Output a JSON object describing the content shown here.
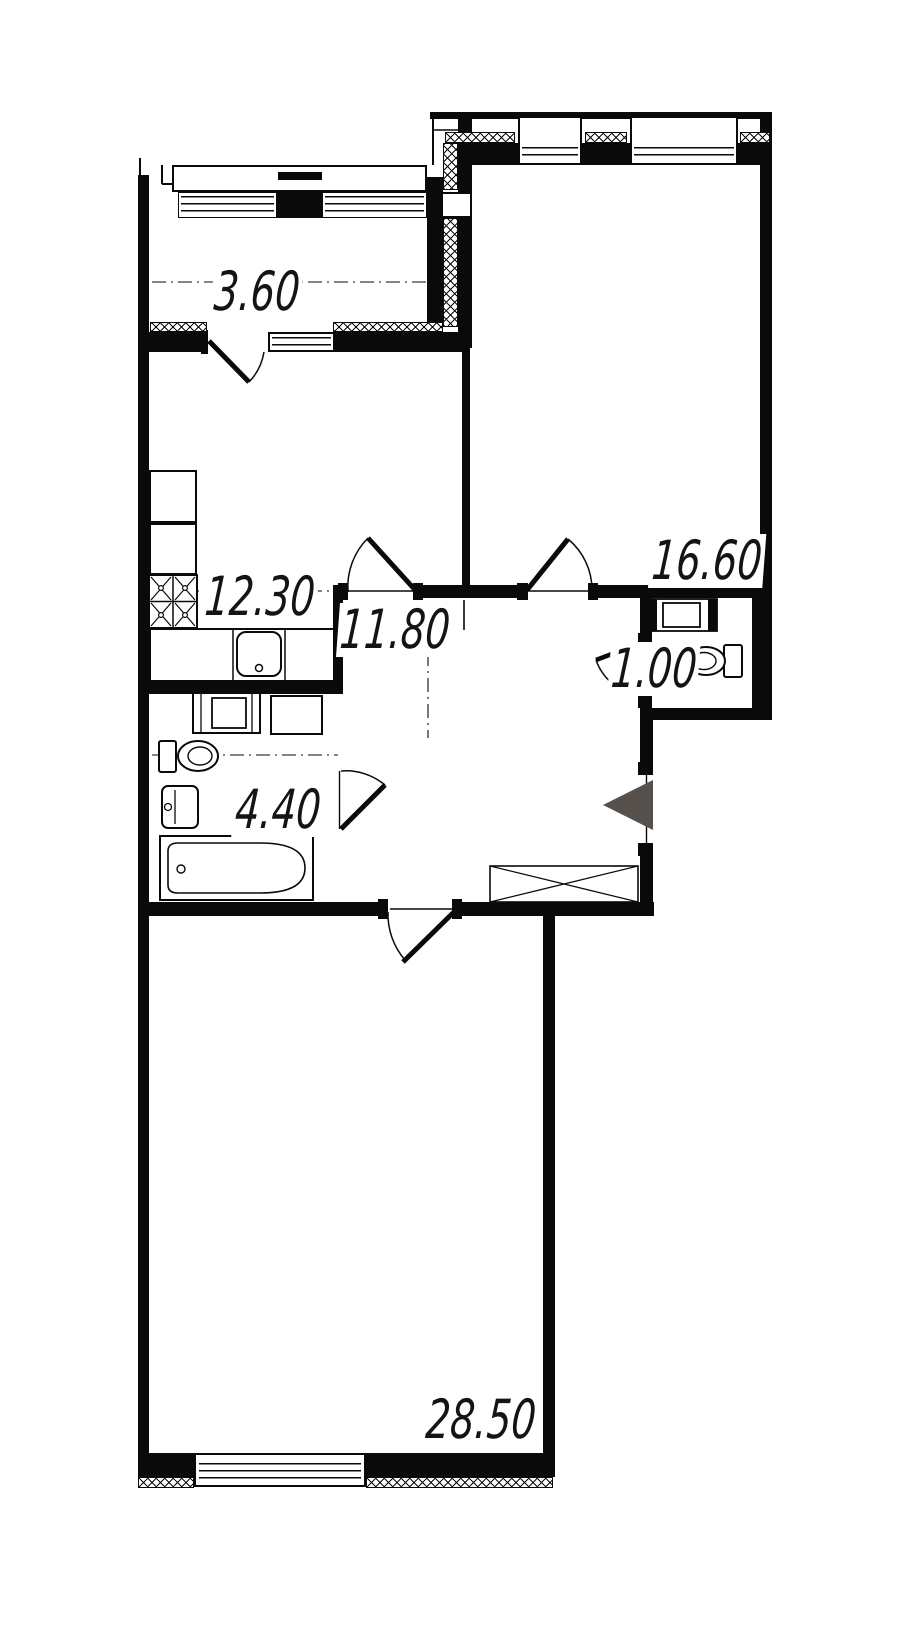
{
  "plan": {
    "title": "apartment floor plan",
    "rooms": [
      {
        "id": "loggia",
        "area": "3.60"
      },
      {
        "id": "kitchen",
        "area": "12.30"
      },
      {
        "id": "hallway",
        "area": "11.80"
      },
      {
        "id": "room-1",
        "area": "16.60"
      },
      {
        "id": "wc",
        "area": "1.00"
      },
      {
        "id": "bathroom",
        "area": "4.40"
      },
      {
        "id": "room-2",
        "area": "28.50"
      }
    ],
    "colors": {
      "walls": "#0a0a0a",
      "background": "#ffffff",
      "entrance_marker": "#56514c"
    }
  }
}
